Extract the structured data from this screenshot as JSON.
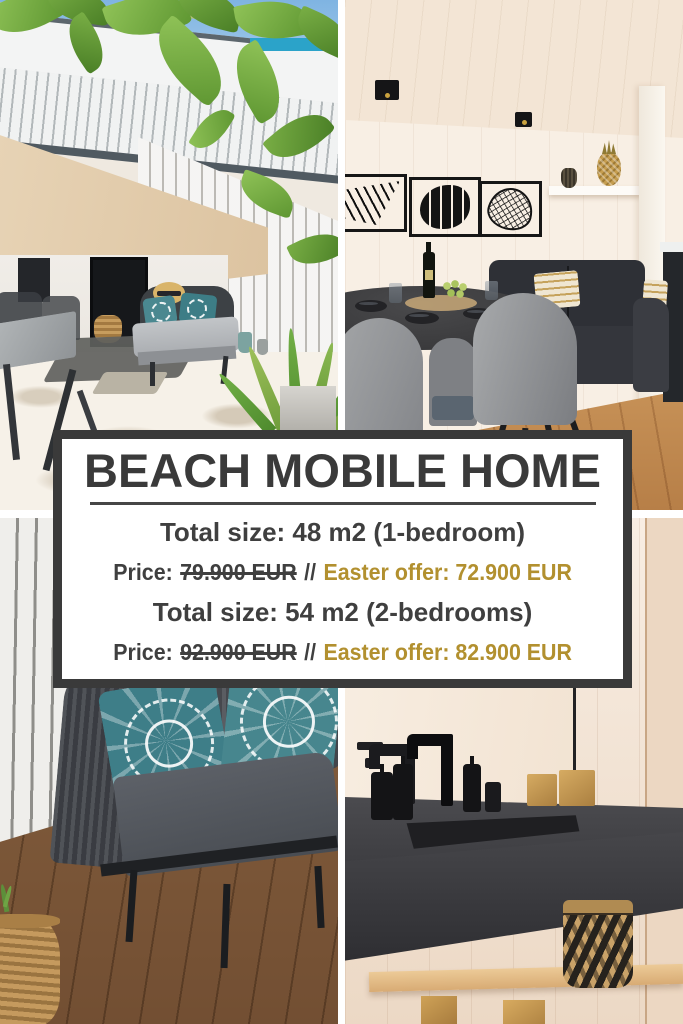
{
  "banner": {
    "title": "BEACH MOBILE HOME",
    "rows": [
      {
        "text": "Total size: 48 m2 (1-bedroom)"
      },
      {
        "prefix": "Price:",
        "old_price": "79.900 EUR",
        "separator": "//",
        "offer": "Easter offer: 72.900 EUR"
      },
      {
        "text": "Total size: 54 m2 (2-bedrooms)"
      },
      {
        "prefix": "Price:",
        "old_price": "92.900 EUR",
        "separator": "//",
        "offer": "Easter offer: 82.900 EUR"
      }
    ],
    "colors": {
      "accent_gold": "#b2902f",
      "text_dark": "#3f3f3f",
      "banner_border": "#3a3a3a",
      "banner_background": "#ffffff",
      "gutter": "#ffffff"
    }
  },
  "photos": {
    "top_left": {
      "description": "Sunny terrace with overhanging vine leaves, white slat walls, grey daybed with straw hat and teal pillows, outdoor dining table and potted plants"
    },
    "top_right": {
      "description": "Dining corner with round black table set with dark bowls, wine bottle and grapes, grey upholstered chairs, dark sofa, three black leaf wall-art frames, shelf with golden pineapple"
    },
    "bottom_left": {
      "description": "Outdoor grey rope sofa with charcoal cushions, two teal mandala-pattern pillows and a straw hat with black bow, on a wooden deck against a white slat wall"
    },
    "bottom_right": {
      "description": "Bathroom with black concrete washbasin, matte black faucet, black soap dispensers, wooden cubes and a black-and-tan woven basket on a wooden shelf"
    }
  }
}
